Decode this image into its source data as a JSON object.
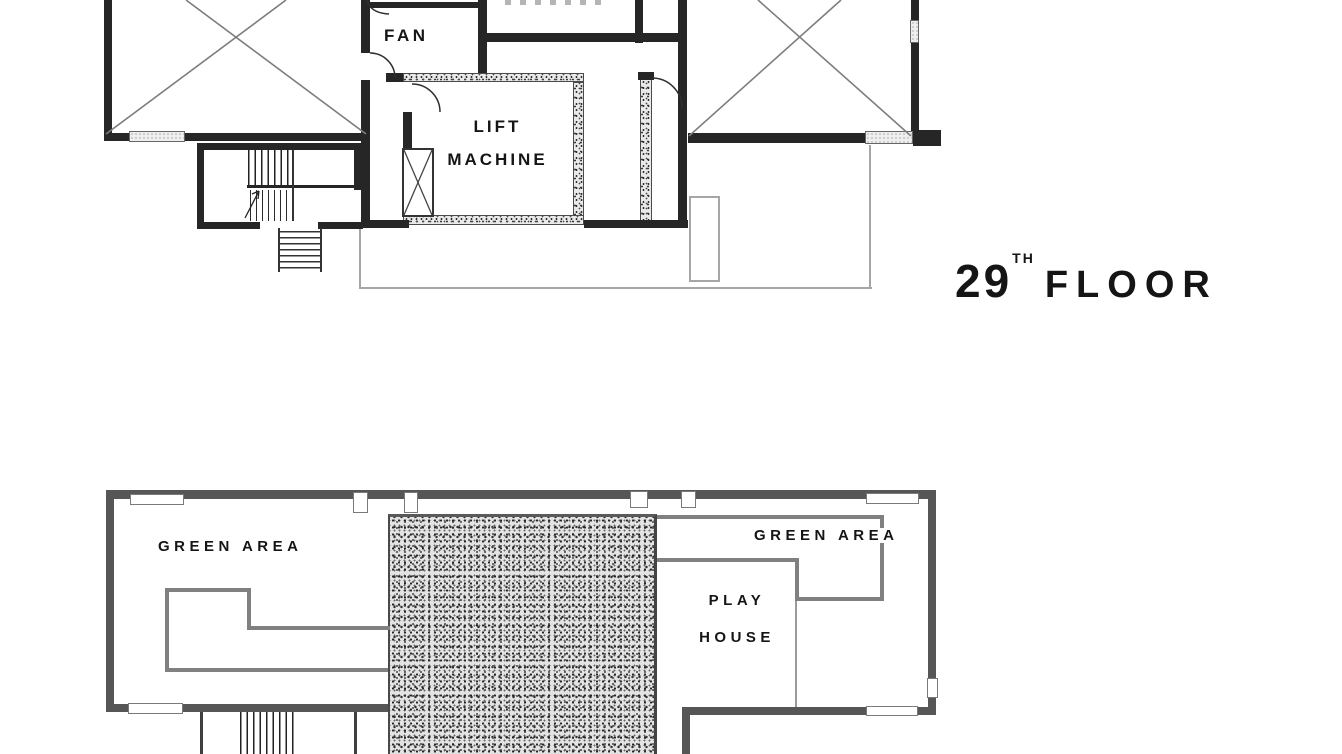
{
  "floor_title": {
    "number": "29",
    "suffix": "TH",
    "word": "FLOOR"
  },
  "upper_plan": {
    "rooms": {
      "fan": "FAN",
      "lift_machine_line1": "LIFT",
      "lift_machine_line2": "MACHINE"
    }
  },
  "lower_plan": {
    "areas": {
      "green_left": "GREEN AREA",
      "green_right": "GREEN AREA",
      "play_house_line1": "PLAY",
      "play_house_line2": "HOUSE"
    }
  },
  "colors": {
    "wall_dark": "#262626",
    "wall_gray": "#565656",
    "inner_gray": "#808080",
    "outline_light": "#a6a6a6",
    "text": "#151515",
    "paper": "#ffffff"
  }
}
